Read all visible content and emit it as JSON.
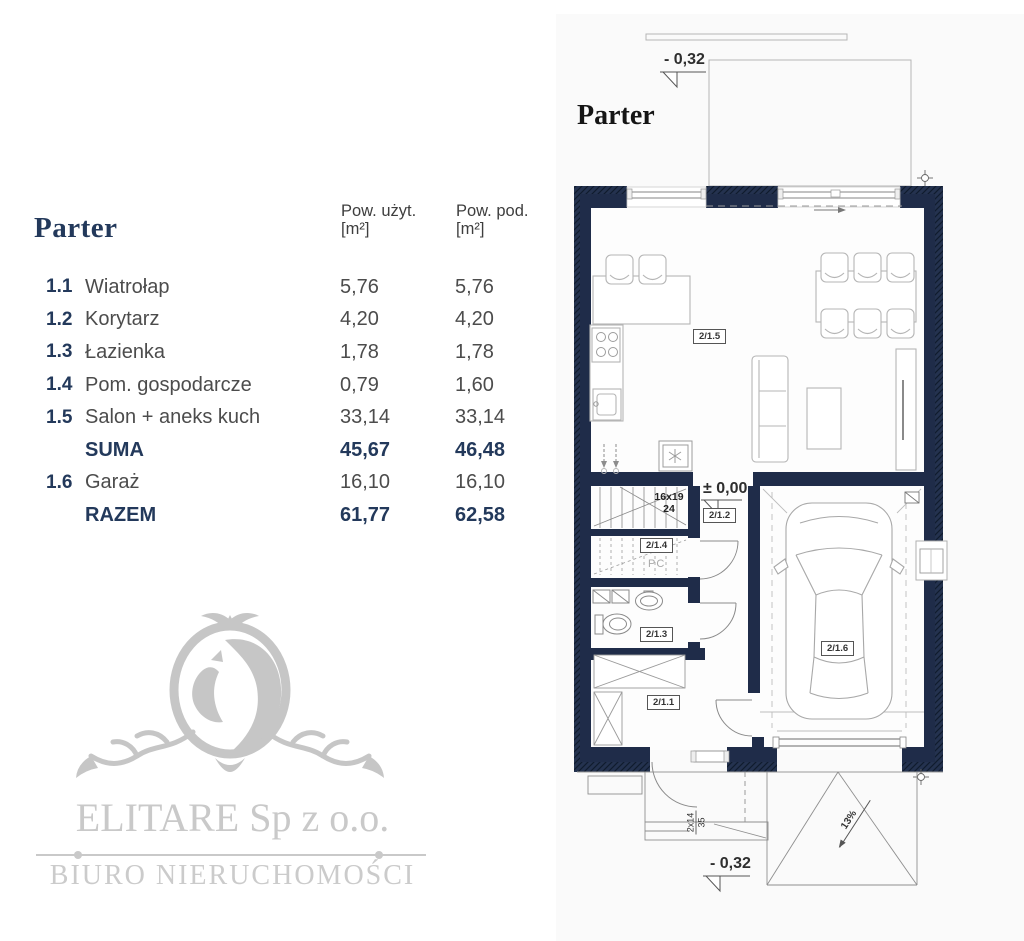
{
  "colors": {
    "wall-color": "#1f2c49",
    "accent": "#23395b",
    "logo-gray": "#c8c8c8"
  },
  "table": {
    "title": "Parter",
    "headers": {
      "col1_line1": "Pow. użyt.",
      "col1_line2": "[m²]",
      "col2_line1": "Pow. pod.",
      "col2_line2": "[m²]"
    },
    "rows": [
      {
        "num": "1.1",
        "name": "Wiatrołap",
        "u": "5,76",
        "p": "5,76"
      },
      {
        "num": "1.2",
        "name": "Korytarz",
        "u": "4,20",
        "p": "4,20"
      },
      {
        "num": "1.3",
        "name": "Łazienka",
        "u": "1,78",
        "p": "1,78"
      },
      {
        "num": "1.4",
        "name": "Pom. gospodarcze",
        "u": "0,79",
        "p": "1,60"
      },
      {
        "num": "1.5",
        "name": "Salon + aneks kuch",
        "u": "33,14",
        "p": "33,14"
      },
      {
        "num": "",
        "name": "SUMA",
        "u": "45,67",
        "p": "46,48"
      },
      {
        "num": "1.6",
        "name": "Garaż",
        "u": "16,10",
        "p": "16,10"
      },
      {
        "num": "",
        "name": "RAZEM",
        "u": "61,77",
        "p": "62,58"
      }
    ]
  },
  "logo": {
    "company": "ELITARE Sp z o.o.",
    "tagline": "BIURO NIERUCHOMOŚCI"
  },
  "plan": {
    "title": "Parter",
    "levels": {
      "top": "- 0,32",
      "zero": "± 0,00",
      "bottom": "- 0,32"
    },
    "stairs": {
      "line1": "16x19",
      "line2": "24"
    },
    "boiler_label": "PC",
    "ext_steps": {
      "line1": "2x14",
      "line2": "35"
    },
    "slope": "13%",
    "rooms": {
      "salon": "2/1.5",
      "korytarz": "2/1.2",
      "gosp": "2/1.4",
      "lazienka": "2/1.3",
      "wiatrolap": "2/1.1",
      "garaz": "2/1.6"
    }
  }
}
